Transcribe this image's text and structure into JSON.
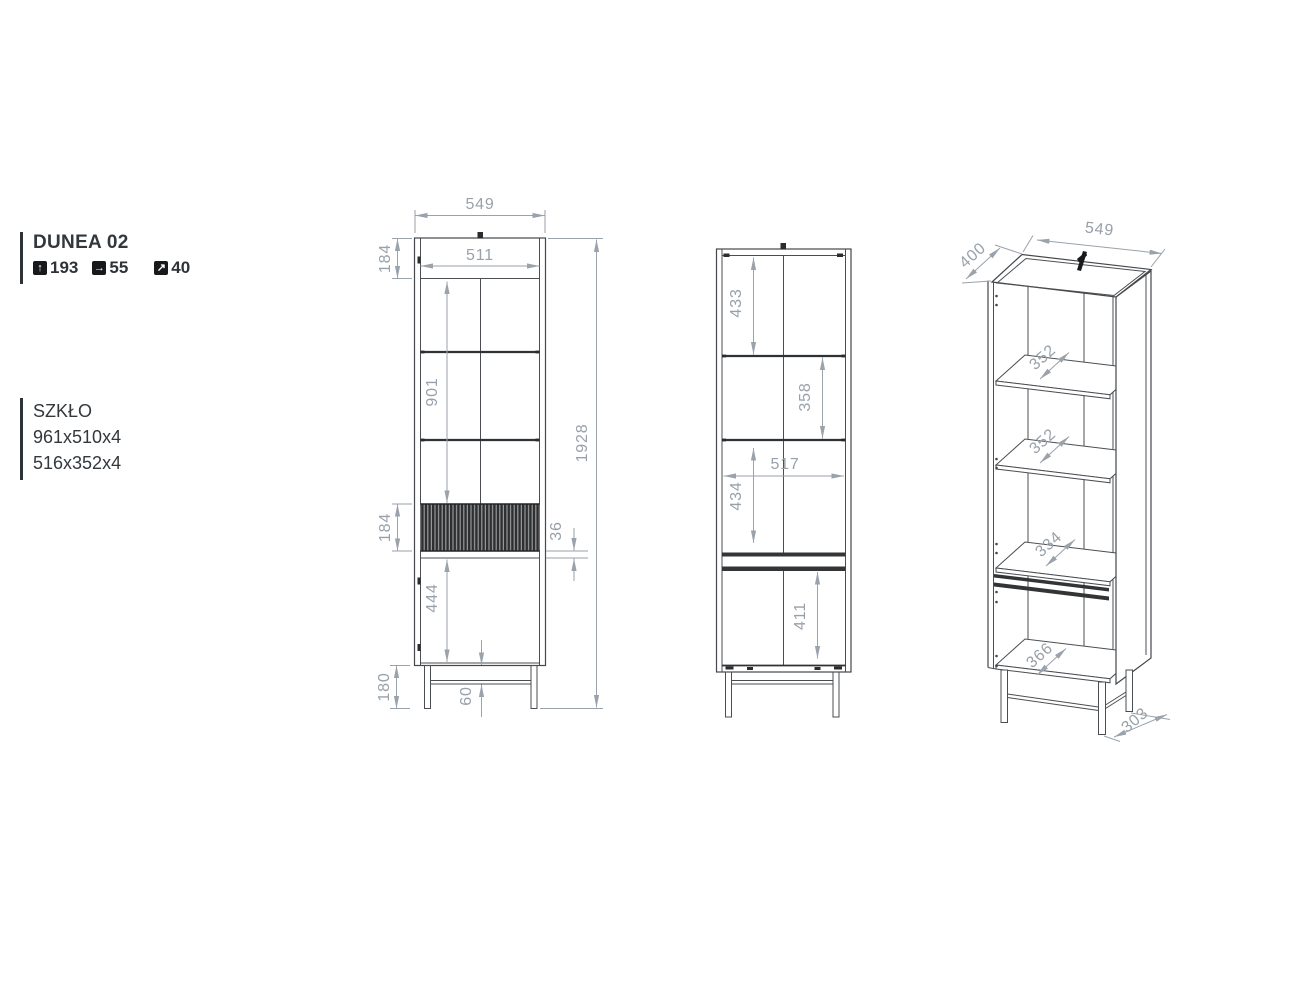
{
  "product": {
    "name": "DUNEA 02",
    "stats": [
      {
        "icon": "arrow-up-icon",
        "value": "193"
      },
      {
        "icon": "arrow-right-icon",
        "value": "55"
      },
      {
        "icon": "arrow-up-right-icon",
        "value": "40"
      }
    ]
  },
  "glass": {
    "label": "SZKŁO",
    "sizes": [
      "961x510x4",
      "516x352x4"
    ]
  },
  "front_view": {
    "width": "549",
    "inner_width": "511",
    "top_section": "184",
    "glass_section": "901",
    "total_height": "1928",
    "band_height": "184",
    "gap": "36",
    "door_height": "444",
    "leg_height": "180",
    "leg_offset": "60"
  },
  "section_view": {
    "compartment1": "433",
    "compartment2": "358",
    "inner_width": "517",
    "compartment3": "434",
    "compartment4": "411"
  },
  "iso_view": {
    "depth": "400",
    "width": "549",
    "shelf1_depth": "352",
    "shelf2_depth": "352",
    "shelf3_depth": "334",
    "bottom_depth": "366",
    "leg_depth": "303"
  },
  "colors": {
    "drawing_line": "#44484c",
    "dimension": "#9aa2ab",
    "text": "#33383d",
    "fluted_band": "#2e2f30"
  }
}
